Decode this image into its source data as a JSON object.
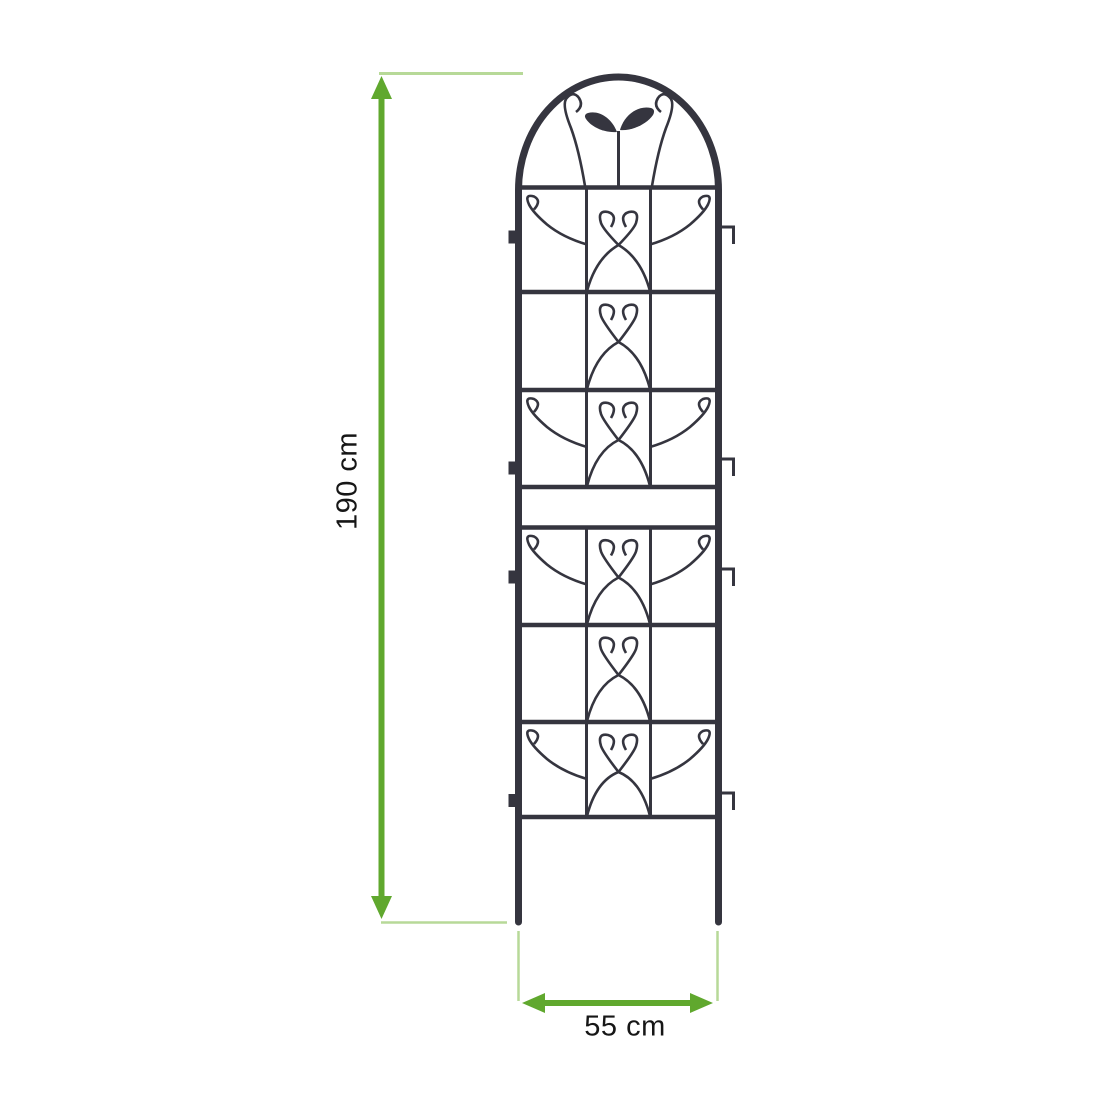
{
  "diagram": {
    "subject": "arched garden trellis with scrollwork and leaf ornament",
    "height_dimension": {
      "label": "190 cm"
    },
    "width_dimension": {
      "label": "55 cm"
    }
  },
  "colors": {
    "dimension_arrow_green": "#60a82e",
    "dimension_extension_green": "#b7d998",
    "trellis_metal_dark": "#35353f",
    "label_text": "#161616",
    "background": "#ffffff"
  },
  "icons": {
    "leaf-icon": "two-leaf sprout ornament at trellis top",
    "vertical-double-arrow-icon": "green double-headed vertical measure arrow",
    "horizontal-double-arrow-icon": "green double-headed horizontal measure arrow"
  }
}
